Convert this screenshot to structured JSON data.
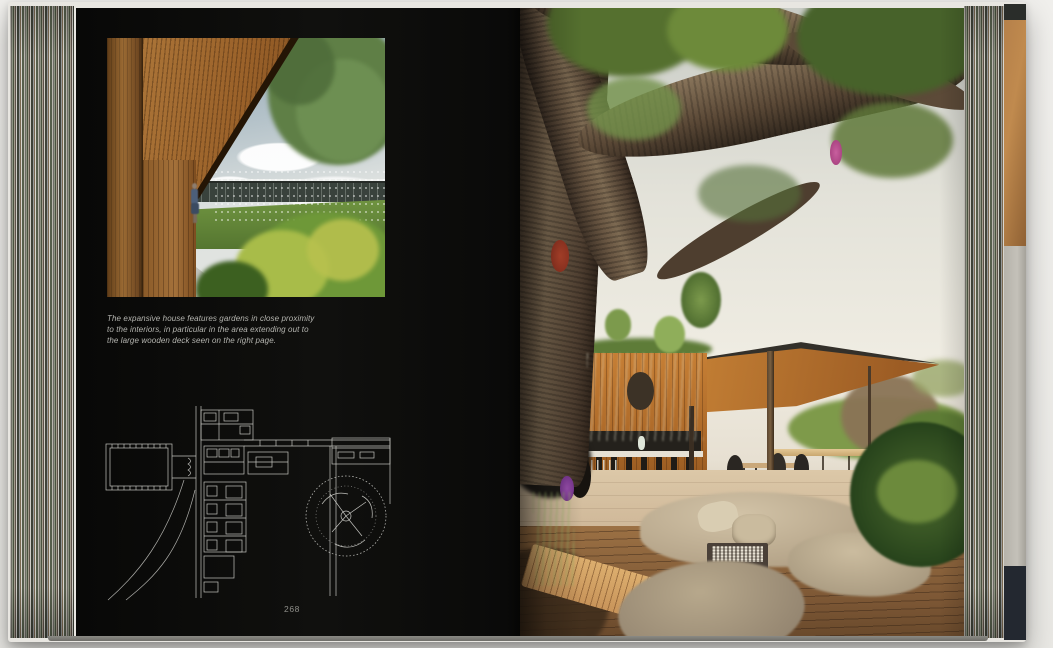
{
  "left_page": {
    "caption": "The expansive house features gardens in close proximity to the interiors, in particular in the area extending out to the large wooden deck seen on the right page.",
    "page_number": "268"
  },
  "colors": {
    "page_background": "#0d0d0b",
    "caption_text": "#b5b5b0",
    "plan_linework": "#d8d8d3",
    "canopy_wood": "#c9883c",
    "kitchen_wall_wood": "#c07a33",
    "deck_wood": "#9c7144",
    "cushion_beige": "#c5b69b",
    "foliage_green": "#5a7735",
    "trunk_brown": "#6b5847",
    "orchid_pink": "#c85f9e",
    "bromeliad_red": "#b5452c"
  }
}
